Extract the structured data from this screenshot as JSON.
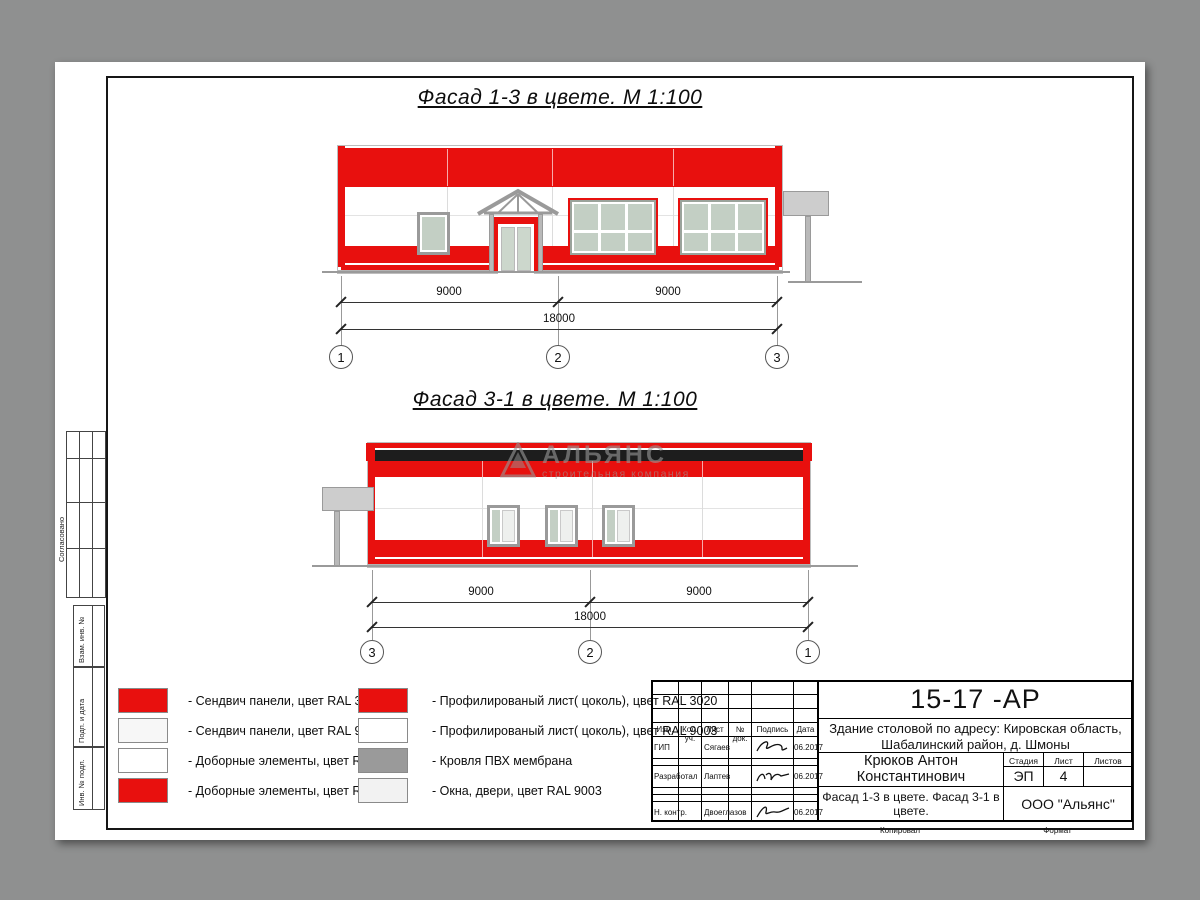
{
  "drawing": {
    "title_facade13": "Фасад 1-3 в цвете.  М 1:100",
    "title_facade31": "Фасад 3-1 в цвете.  М 1:100"
  },
  "colors": {
    "sandwich_red_ral3020": "#e8100e",
    "sandwich_white_ral9003": "#f7f7f7",
    "elements_white_ral9003": "#ffffff",
    "pvc_membrane_gray": "#9a9a9a",
    "windows_light_ral9003": "#f2f2f2",
    "glass": "#c3cfc4",
    "roof_band_black": "#1d1d1d"
  },
  "facade13_dims": {
    "left": "9000",
    "right": "9000",
    "total": "18000",
    "axis_left": "1",
    "axis_mid": "2",
    "axis_right": "3"
  },
  "facade31_dims": {
    "left": "9000",
    "right": "9000",
    "total": "18000",
    "axis_left": "3",
    "axis_mid": "2",
    "axis_right": "1"
  },
  "watermark": {
    "title": "АЛЬЯНС",
    "subtitle": "строительная компания"
  },
  "legend": {
    "left": [
      {
        "color": "#e8100e",
        "label": "- Сендвич панели, цвет RAL 3020"
      },
      {
        "color": "#f7f7f7",
        "label": "- Сендвич панели, цвет RAL 9003"
      },
      {
        "color": "#ffffff",
        "label": "- Доборные элементы, цвет RAL 9003"
      },
      {
        "color": "#e8100e",
        "label": "- Доборные элементы, цвет RAL 3020"
      }
    ],
    "right": [
      {
        "color": "#e8100e",
        "label": "- Профилированый лист( цоколь), цвет RAL 3020"
      },
      {
        "color": "#ffffff",
        "label": "- Профилированый лист( цоколь), цвет RAL 9003"
      },
      {
        "color": "#9a9a9a",
        "label": "- Кровля ПВХ мембрана"
      },
      {
        "color": "#f2f2f2",
        "label": "- Окна, двери, цвет RAL 9003"
      }
    ]
  },
  "title_block": {
    "code": "15-17 -АР",
    "object_line1": "Здание столовой по адресу: Кировская область,",
    "object_line2": "Шабалинский район, д. Шмоны",
    "header": [
      "Изм.",
      "Кол. уч.",
      "Лист",
      "№ док.",
      "Подпись",
      "Дата"
    ],
    "rows": [
      {
        "role": "ГИП",
        "name": "Сягаев",
        "date": "06.2017"
      },
      {
        "role": "Разработал",
        "name": "Лаптев",
        "date": "06.2017"
      },
      {
        "role": "Н. контр.",
        "name": "Двоеглазов",
        "date": "06.2017"
      }
    ],
    "chief": "Крюков Антон Константинович",
    "stage_label": "Стадия",
    "sheet_label": "Лист",
    "sheets_label": "Листов",
    "stage": "ЭП",
    "sheet": "4",
    "sheets": "",
    "sheet_title": "Фасад 1-3 в цвете. Фасад 3-1 в цвете.",
    "company": "ООО \"Альянс\"",
    "copied": "Копировал",
    "format": "Формат"
  },
  "margin": {
    "soglasovano": "Согласовано",
    "boxes": [
      "Взам. инв. №",
      "Подп. и дата",
      "Инв. № подл."
    ]
  }
}
